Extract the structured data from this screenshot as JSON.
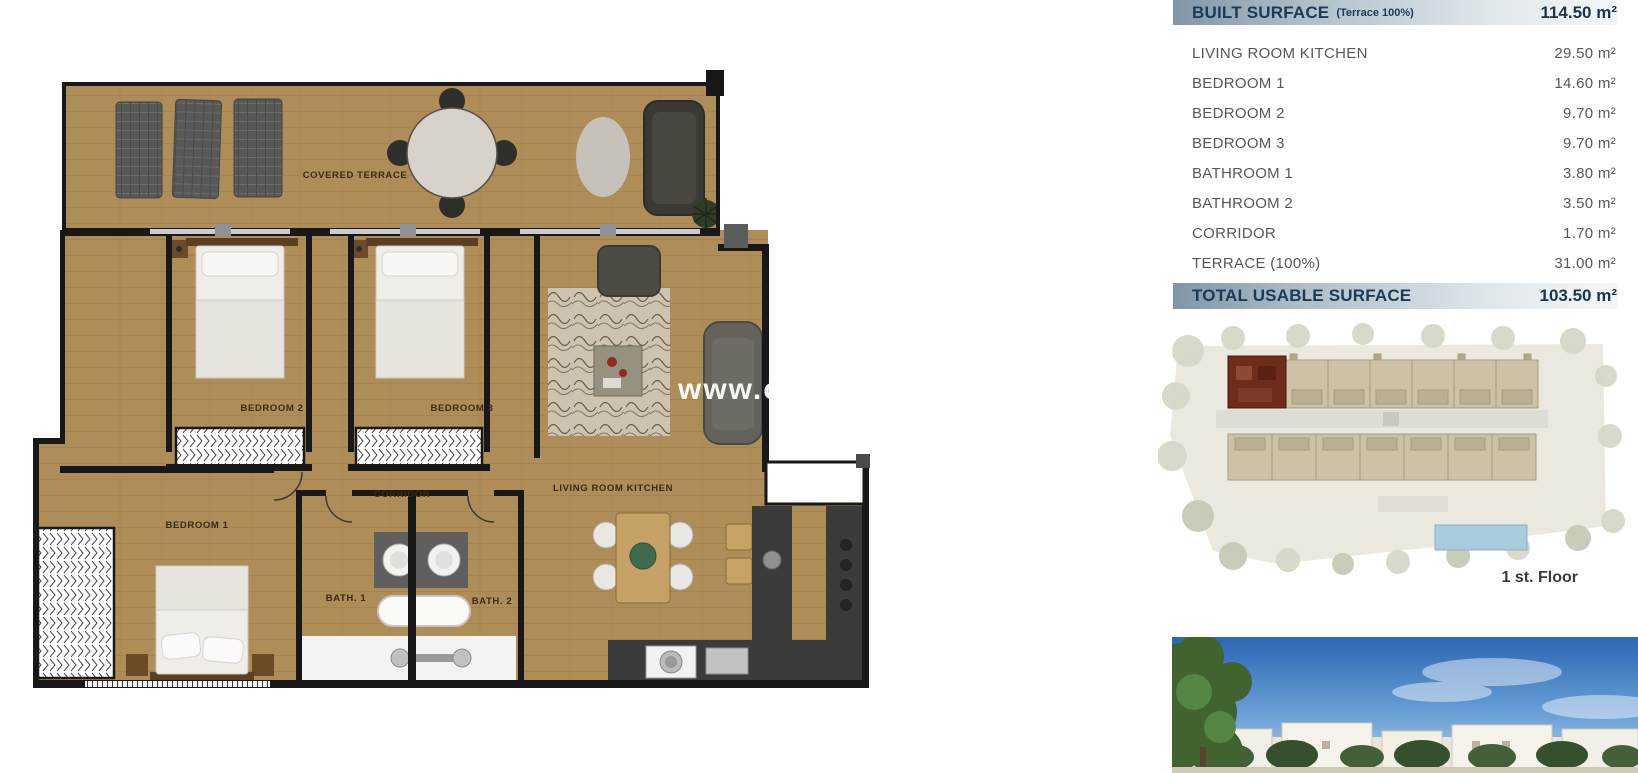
{
  "floor_plan": {
    "labels": {
      "covered_terrace": "COVERED TERRACE",
      "bedroom_2": "BEDROOM 2",
      "bedroom_3": "BEDROOM 3",
      "corridor": "CORRIDOR",
      "living_room_kitchen": "LIVING ROOM KITCHEN",
      "bedroom_1": "BEDROOM 1",
      "bath_1": "BATH. 1",
      "bath_2": "BATH. 2"
    },
    "watermark": "www.ca"
  },
  "surface_table": {
    "header": {
      "label": "BUILT SURFACE",
      "note": "(Terrace 100%)",
      "value": "114.50 m²"
    },
    "rows": [
      {
        "label": "LIVING ROOM KITCHEN",
        "value": "29.50 m²"
      },
      {
        "label": "BEDROOM 1",
        "value": "14.60 m²"
      },
      {
        "label": "BEDROOM 2",
        "value": "9.70 m²"
      },
      {
        "label": "BEDROOM 3",
        "value": "9.70 m²"
      },
      {
        "label": "BATHROOM 1",
        "value": "3.80 m²"
      },
      {
        "label": "BATHROOM 2",
        "value": "3.50 m²"
      },
      {
        "label": "CORRIDOR",
        "value": "1.70 m²"
      },
      {
        "label": "TERRACE (100%)",
        "value": "31.00 m²"
      }
    ],
    "total": {
      "label": "TOTAL USABLE SURFACE",
      "value": "103.50 m²"
    }
  },
  "site_plan": {
    "caption": "1 st. Floor",
    "highlighted_unit": "top-left"
  },
  "colors": {
    "table_header_text": "#1d3a55",
    "table_row_text": "#54585e",
    "band_gradient_left": "#8195a6",
    "band_gradient_right": "#f5f7f9",
    "floor_wood": "#ad8c57",
    "wall": "#181818",
    "highlighted_unit": "#6f2b1b",
    "pool": "#a9cbde",
    "sky": "#2c66b4",
    "watermark_text": "#ffffff"
  }
}
